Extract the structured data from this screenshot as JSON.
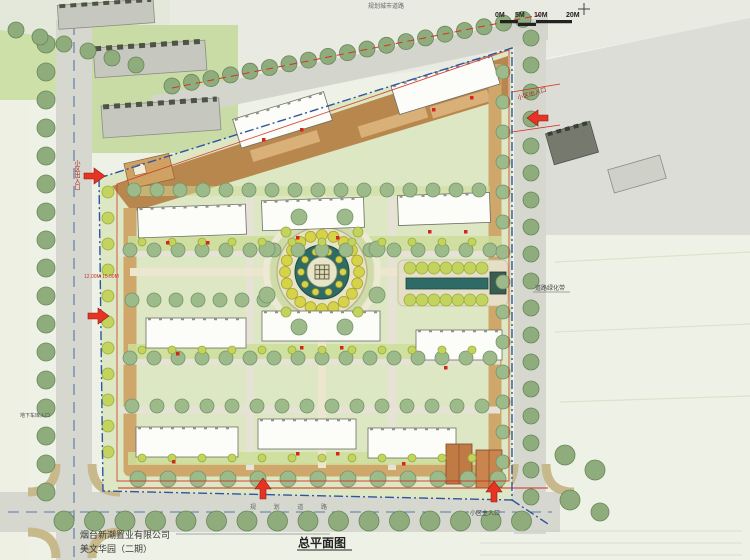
{
  "document": {
    "type_label": "总平面图",
    "company": "烟台新潮置业有限公司",
    "project": "美文华园（二期）"
  },
  "scale_bar": {
    "labels": [
      "0M",
      "5M",
      "10M",
      "20M"
    ]
  },
  "annotations": {
    "entrance_side": "小区出入口",
    "entrance_top_right": "小区出入口",
    "entrance_main": "小区主入口",
    "road_top": "规划城市道路",
    "road_bottom": "规 划 道 路",
    "greenbelt": "道路绿化带",
    "garage": "地下车库入口",
    "dims_left": "12.00M 15.00M"
  },
  "colors": {
    "lawn": "#dde7c4",
    "road": "#d6d8d0",
    "loop_road": "#cfa76b",
    "paving_band": "#b8874e",
    "street_tree": "#8fac7c",
    "interior_tree": "#9dbb8a",
    "shrub": "#c3d45e",
    "building": "#fcfcf8",
    "water_teal": "#2e6b66",
    "boundary_blue": "#2f54a0",
    "red_line": "#cf2b20",
    "arrow_red": "#e63323"
  }
}
